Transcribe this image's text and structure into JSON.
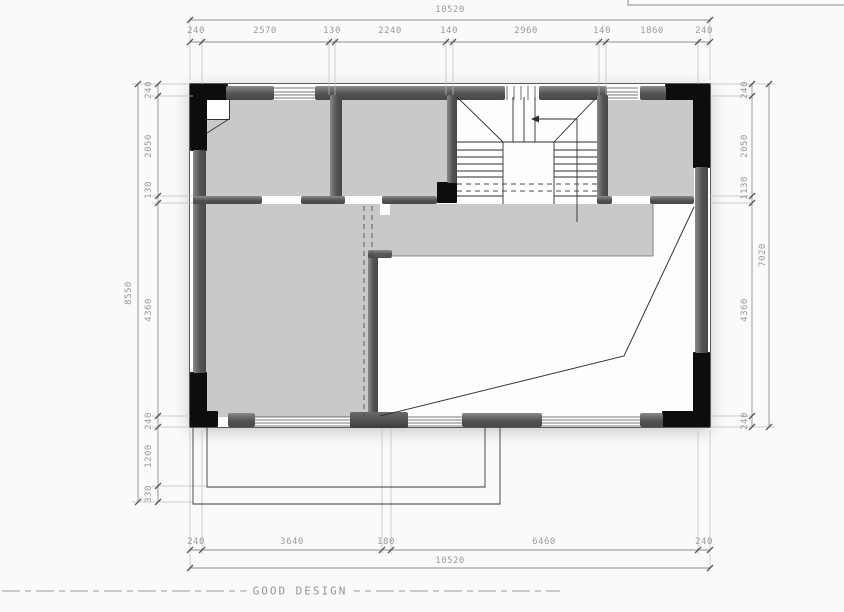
{
  "dimensions": {
    "top": {
      "total": "10520",
      "segments": [
        "240",
        "2570",
        "130",
        "2240",
        "140",
        "2960",
        "140",
        "1860",
        "240"
      ]
    },
    "bottom": {
      "total": "10520",
      "segments": [
        "240",
        "3640",
        "180",
        "6460",
        "240"
      ]
    },
    "left": {
      "total": "8550",
      "segments": [
        "240",
        "2050",
        "130",
        "4360",
        "240",
        "1200",
        "330"
      ]
    },
    "right": {
      "total": "7020",
      "segments": [
        "240",
        "2050",
        "1130",
        "4360",
        "240"
      ]
    }
  },
  "footer": {
    "text": "GOOD DESIGN"
  },
  "colors": {
    "wall_black": "#0d0d0d",
    "wall_gray": "#555555",
    "room_fill": "#c9c9c9",
    "dimension_gray": "#9a9a9a",
    "line_dark": "#333333"
  }
}
